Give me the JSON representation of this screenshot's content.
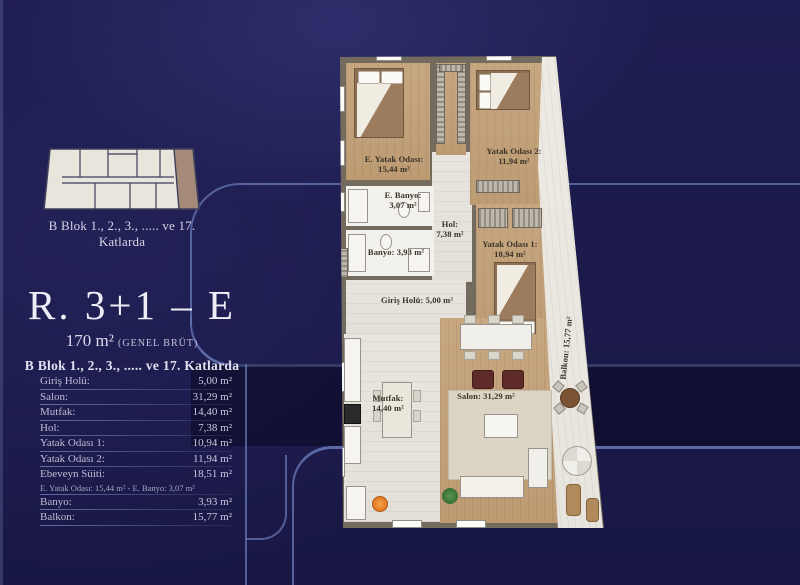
{
  "colors": {
    "background_navy": "#1b1a4a",
    "deco_line": "#6170ac",
    "band_fill": "#121039",
    "plan_wall": "#746b5f",
    "wood_floor": "#c2a37e",
    "tile_floor": "#e6e4dc",
    "balcony_floor": "#ece9e2",
    "keyplan_building": "#e8e5dd",
    "keyplan_highlight": "#a58a79",
    "text_light": "#eeeef8",
    "table_text": "#bdbcd6"
  },
  "key_plan": {
    "caption": "B Blok 1., 2., 3., ..... ve 17. Katlarda"
  },
  "title_block": {
    "title": "R. 3+1 – E",
    "area": "170 m²",
    "area_note": "(GENEL BRÜT)",
    "floors": "B Blok 1., 2., 3., ..... ve 17. Katlarda"
  },
  "area_table": {
    "rows": [
      {
        "label": "Giriş Holü:",
        "value": "5,00 m²"
      },
      {
        "label": "Salon:",
        "value": "31,29 m²"
      },
      {
        "label": "Mutfak:",
        "value": "14,40 m²"
      },
      {
        "label": "Hol:",
        "value": "7,38 m²"
      },
      {
        "label": "Yatak Odası 1:",
        "value": "10,94 m²"
      },
      {
        "label": "Yatak Odası 2:",
        "value": "11,94 m²"
      },
      {
        "label": "Ebeveyn Süiti:",
        "value": "18,51 m²",
        "sub": "E. Yatak Odası: 15,44 m²  -  E. Banyo: 3,07 m²"
      },
      {
        "label": "Banyo:",
        "value": "3,93 m²"
      },
      {
        "label": "Balkon:",
        "value": "15,77 m²"
      }
    ]
  },
  "floor_plan": {
    "rooms": [
      {
        "name": "E. Yatak Odası:",
        "area": "15,44 m²"
      },
      {
        "name": "E. Banyo:",
        "area": "3,07 m²"
      },
      {
        "name": "Banyo:",
        "area": "3,93 m²"
      },
      {
        "name": "Hol:",
        "area": "7,38 m²"
      },
      {
        "name": "Yatak Odası 1:",
        "area": "10,94 m²"
      },
      {
        "name": "Yatak Odası 2:",
        "area": "11,94 m²"
      },
      {
        "name": "Giriş Holü:",
        "area": "5,00 m²"
      },
      {
        "name": "Mutfak:",
        "area": "14,40 m²"
      },
      {
        "name": "Salon:",
        "area": "31,29 m²"
      },
      {
        "name": "Balkon:",
        "area": "15,77 m²"
      }
    ]
  }
}
